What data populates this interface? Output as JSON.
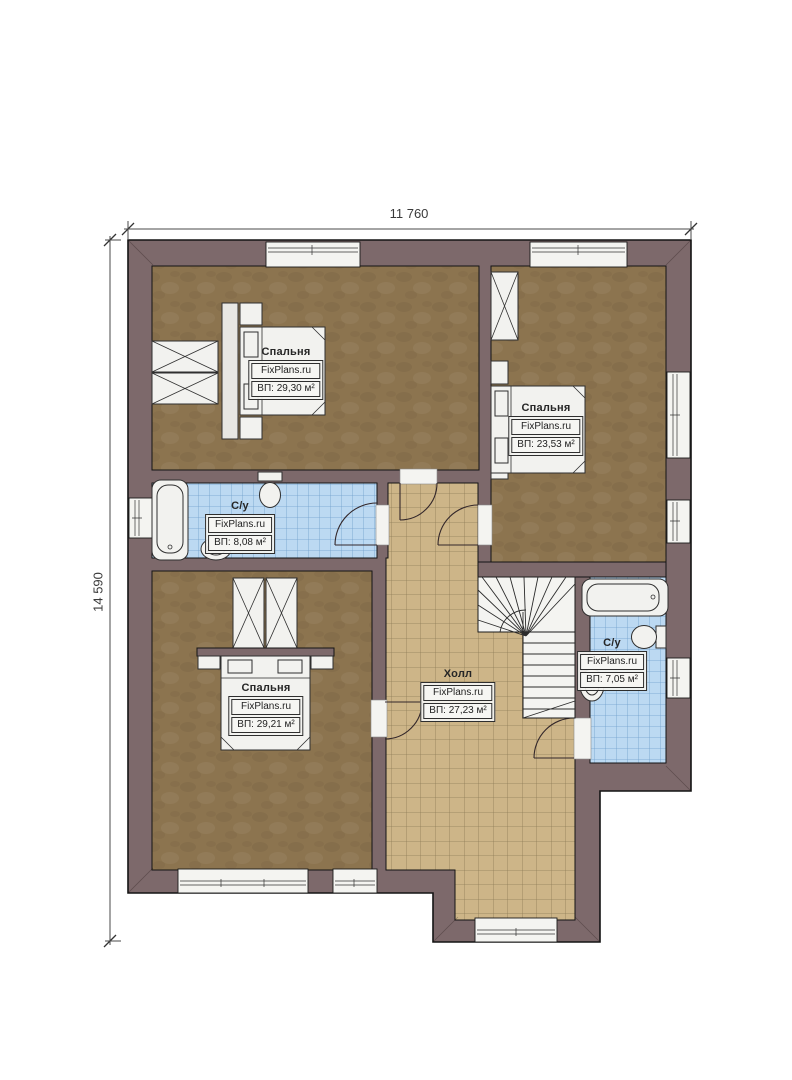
{
  "brand": "FixPlans.ru",
  "dimensions": {
    "width_label": "11 760",
    "height_label": "14 590"
  },
  "rooms": {
    "bedroom_top_left": {
      "name": "Спальня",
      "brand": "FixPlans.ru",
      "area": "ВП: 29,30 м²"
    },
    "bedroom_top_right": {
      "name": "Спальня",
      "brand": "FixPlans.ru",
      "area": "ВП: 23,53 м²"
    },
    "bathroom_left": {
      "name": "С/у",
      "brand": "FixPlans.ru",
      "area": "ВП: 8,08 м²"
    },
    "bedroom_bottom_left": {
      "name": "Спальня",
      "brand": "FixPlans.ru",
      "area": "ВП: 29,21 м²"
    },
    "hall": {
      "name": "Холл",
      "brand": "FixPlans.ru",
      "area": "ВП: 27,23 м²"
    },
    "bathroom_right": {
      "name": "С/у",
      "brand": "FixPlans.ru",
      "area": "ВП: 7,05 м²"
    }
  },
  "colors": {
    "wall": "#7d696b",
    "bedroom_floor": "#8c744f",
    "bathroom_floor": "#bcd9f2",
    "hall_floor": "#cdb588",
    "fixture": "#f2f2ef",
    "outline": "#141414"
  }
}
